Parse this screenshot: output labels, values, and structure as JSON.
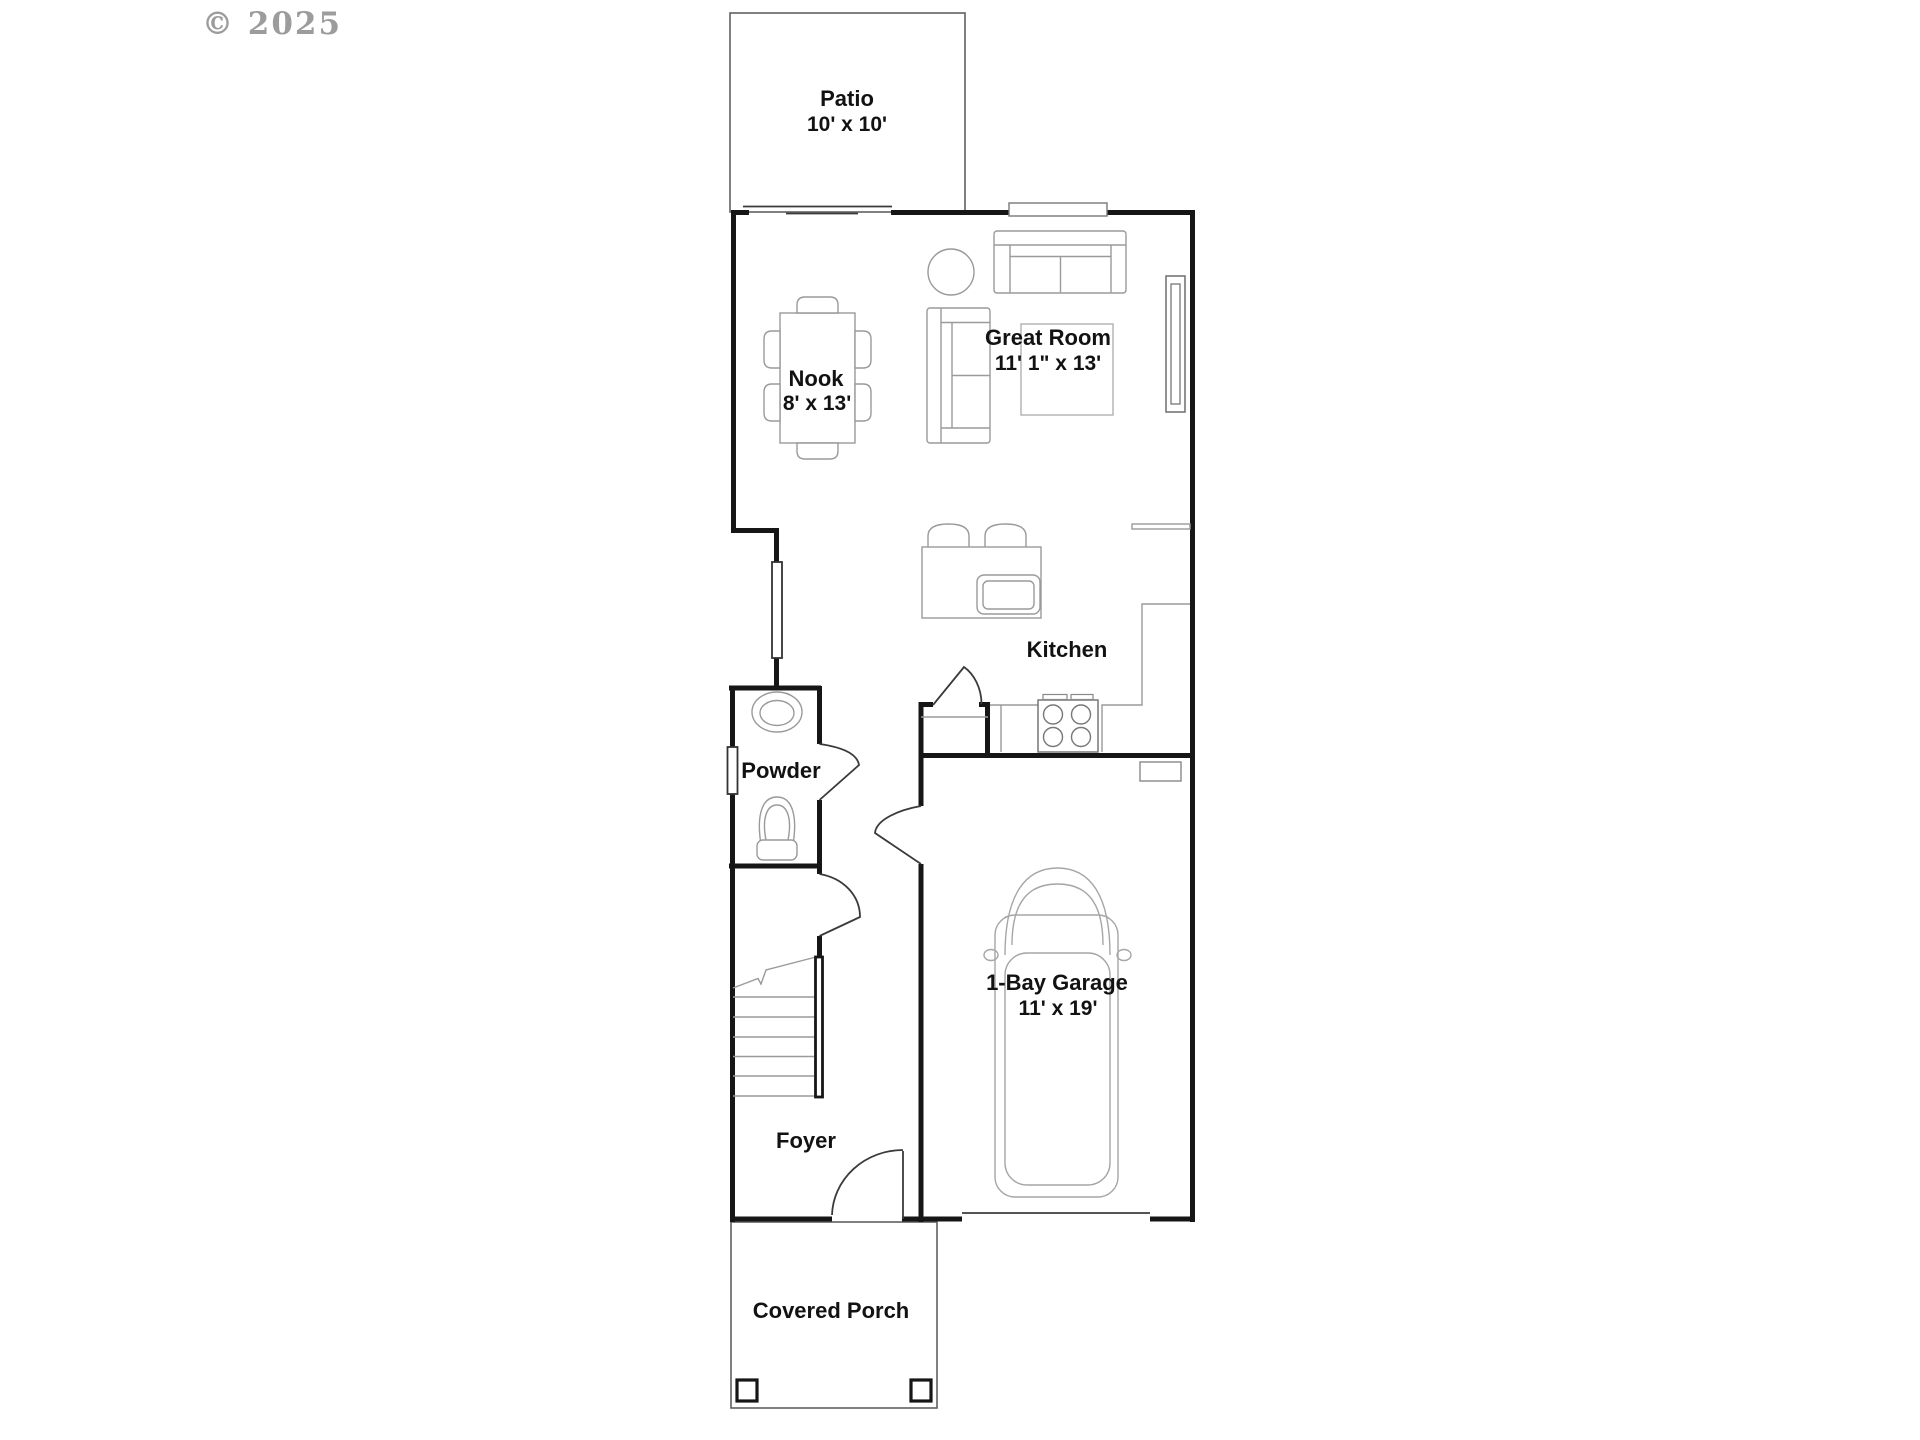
{
  "watermark": {
    "text": "© 2025"
  },
  "rooms": {
    "patio": {
      "name": "Patio",
      "dimensions": "10' x 10'"
    },
    "great_room": {
      "name": "Great Room",
      "dimensions": "11' 1\" x 13'"
    },
    "nook": {
      "name": "Nook",
      "dimensions": "8' x 13'"
    },
    "kitchen": {
      "name": "Kitchen"
    },
    "powder": {
      "name": "Powder"
    },
    "foyer": {
      "name": "Foyer"
    },
    "garage": {
      "name": "1-Bay Garage",
      "dimensions": "11' x 19'"
    },
    "covered_porch": {
      "name": "Covered Porch"
    }
  },
  "colors": {
    "wall": "#161616",
    "furniture_line": "#9a9a9a",
    "outline_line": "#616161",
    "door_line": "#3a3a3a",
    "watermark": "#8b8b8b",
    "background": "#ffffff"
  }
}
